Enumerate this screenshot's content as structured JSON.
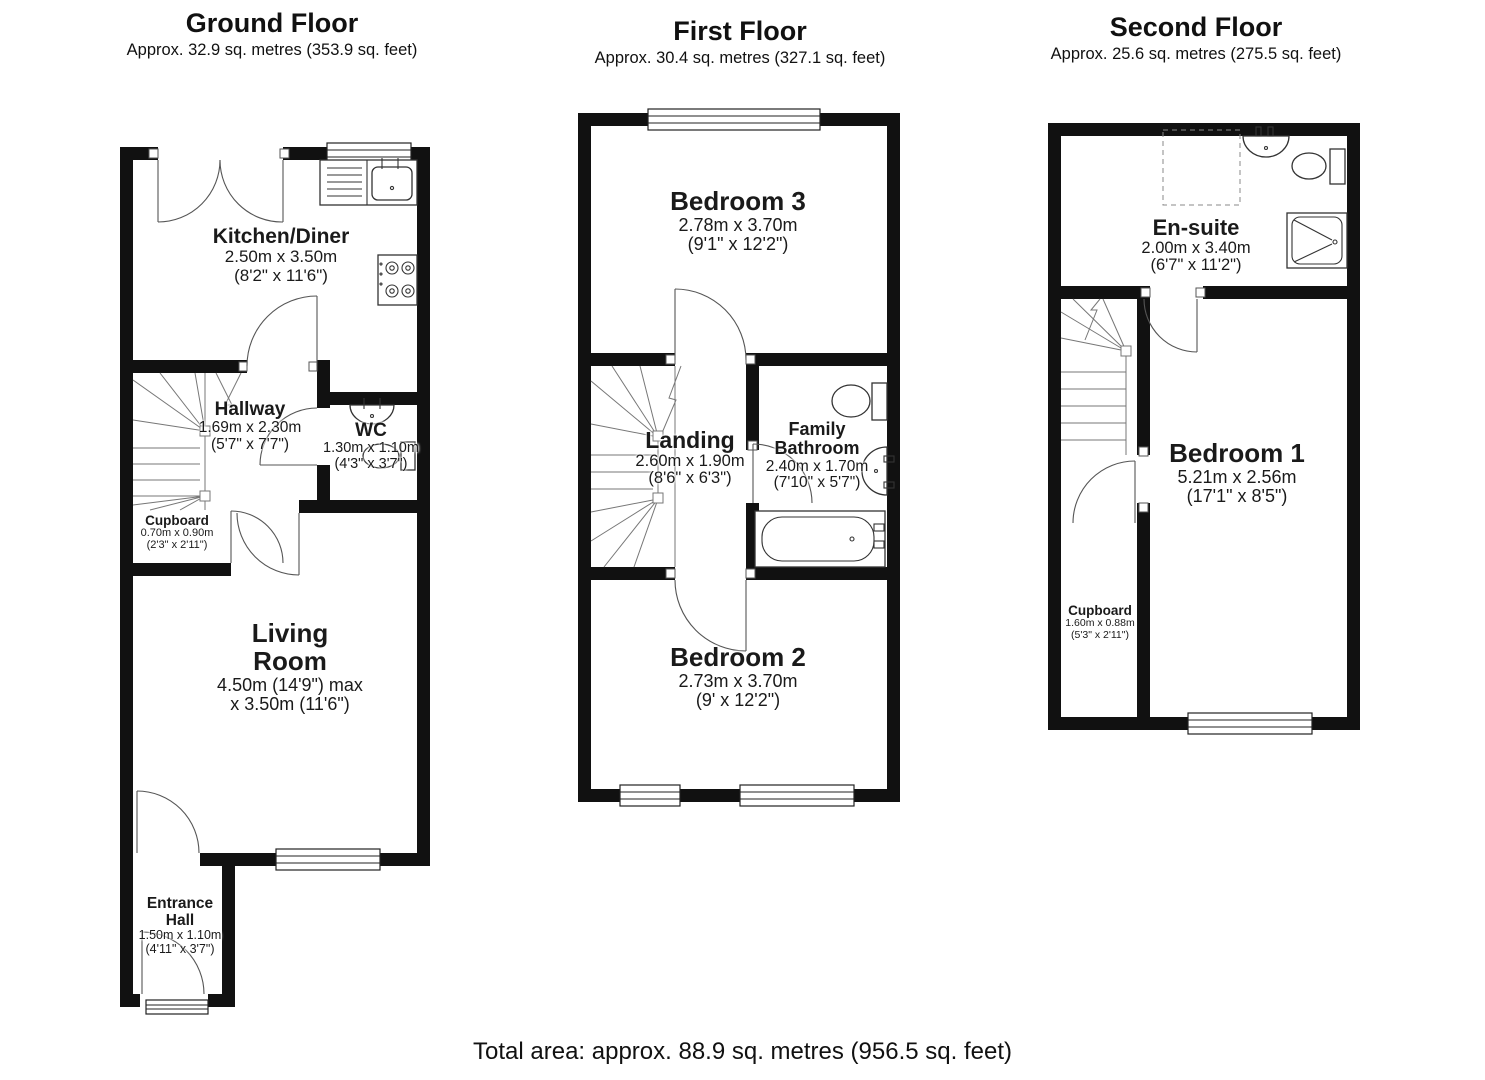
{
  "ground": {
    "title": "Ground Floor",
    "area": "Approx. 32.9 sq. metres (353.9 sq. feet)",
    "kitchen": {
      "name": "Kitchen/Diner",
      "metric": "2.50m x 3.50m",
      "imperial": "(8'2\" x 11'6\")"
    },
    "hallway": {
      "name": "Hallway",
      "metric": "1.69m x 2.30m",
      "imperial": "(5'7\" x 7'7\")"
    },
    "wc": {
      "name": "WC",
      "metric": "1.30m x 1.10m",
      "imperial": "(4'3\" x 3'7\")"
    },
    "cupboard": {
      "name": "Cupboard",
      "metric": "0.70m x 0.90m",
      "imperial": "(2'3\" x 2'11\")"
    },
    "living": {
      "name_line1": "Living",
      "name_line2": "Room",
      "metric": "4.50m (14'9\") max",
      "imperial": "x 3.50m (11'6\")"
    },
    "entrance": {
      "name_line1": "Entrance",
      "name_line2": "Hall",
      "metric": "1.50m x 1.10m",
      "imperial": "(4'11\" x 3'7\")"
    }
  },
  "first": {
    "title": "First Floor",
    "area": "Approx. 30.4 sq. metres (327.1 sq. feet)",
    "bedroom3": {
      "name": "Bedroom 3",
      "metric": "2.78m x 3.70m",
      "imperial": "(9'1\" x 12'2\")"
    },
    "landing": {
      "name": "Landing",
      "metric": "2.60m x 1.90m",
      "imperial": "(8'6\" x 6'3\")"
    },
    "bathroom": {
      "name_line1": "Family",
      "name_line2": "Bathroom",
      "metric": "2.40m x 1.70m",
      "imperial": "(7'10\" x 5'7\")"
    },
    "bedroom2": {
      "name": "Bedroom 2",
      "metric": "2.73m x 3.70m",
      "imperial": "(9' x 12'2\")"
    }
  },
  "second": {
    "title": "Second Floor",
    "area": "Approx. 25.6 sq. metres (275.5 sq. feet)",
    "ensuite": {
      "name": "En-suite",
      "metric": "2.00m x 3.40m",
      "imperial": "(6'7\" x 11'2\")"
    },
    "bedroom1": {
      "name": "Bedroom 1",
      "metric": "5.21m x 2.56m",
      "imperial": "(17'1\" x 8'5\")"
    },
    "cupboard": {
      "name": "Cupboard",
      "metric": "1.60m x 0.88m",
      "imperial": "(5'3\" x 2'11\")"
    }
  },
  "footer": {
    "total": "Total area: approx. 88.9 sq. metres (956.5 sq. feet)"
  }
}
